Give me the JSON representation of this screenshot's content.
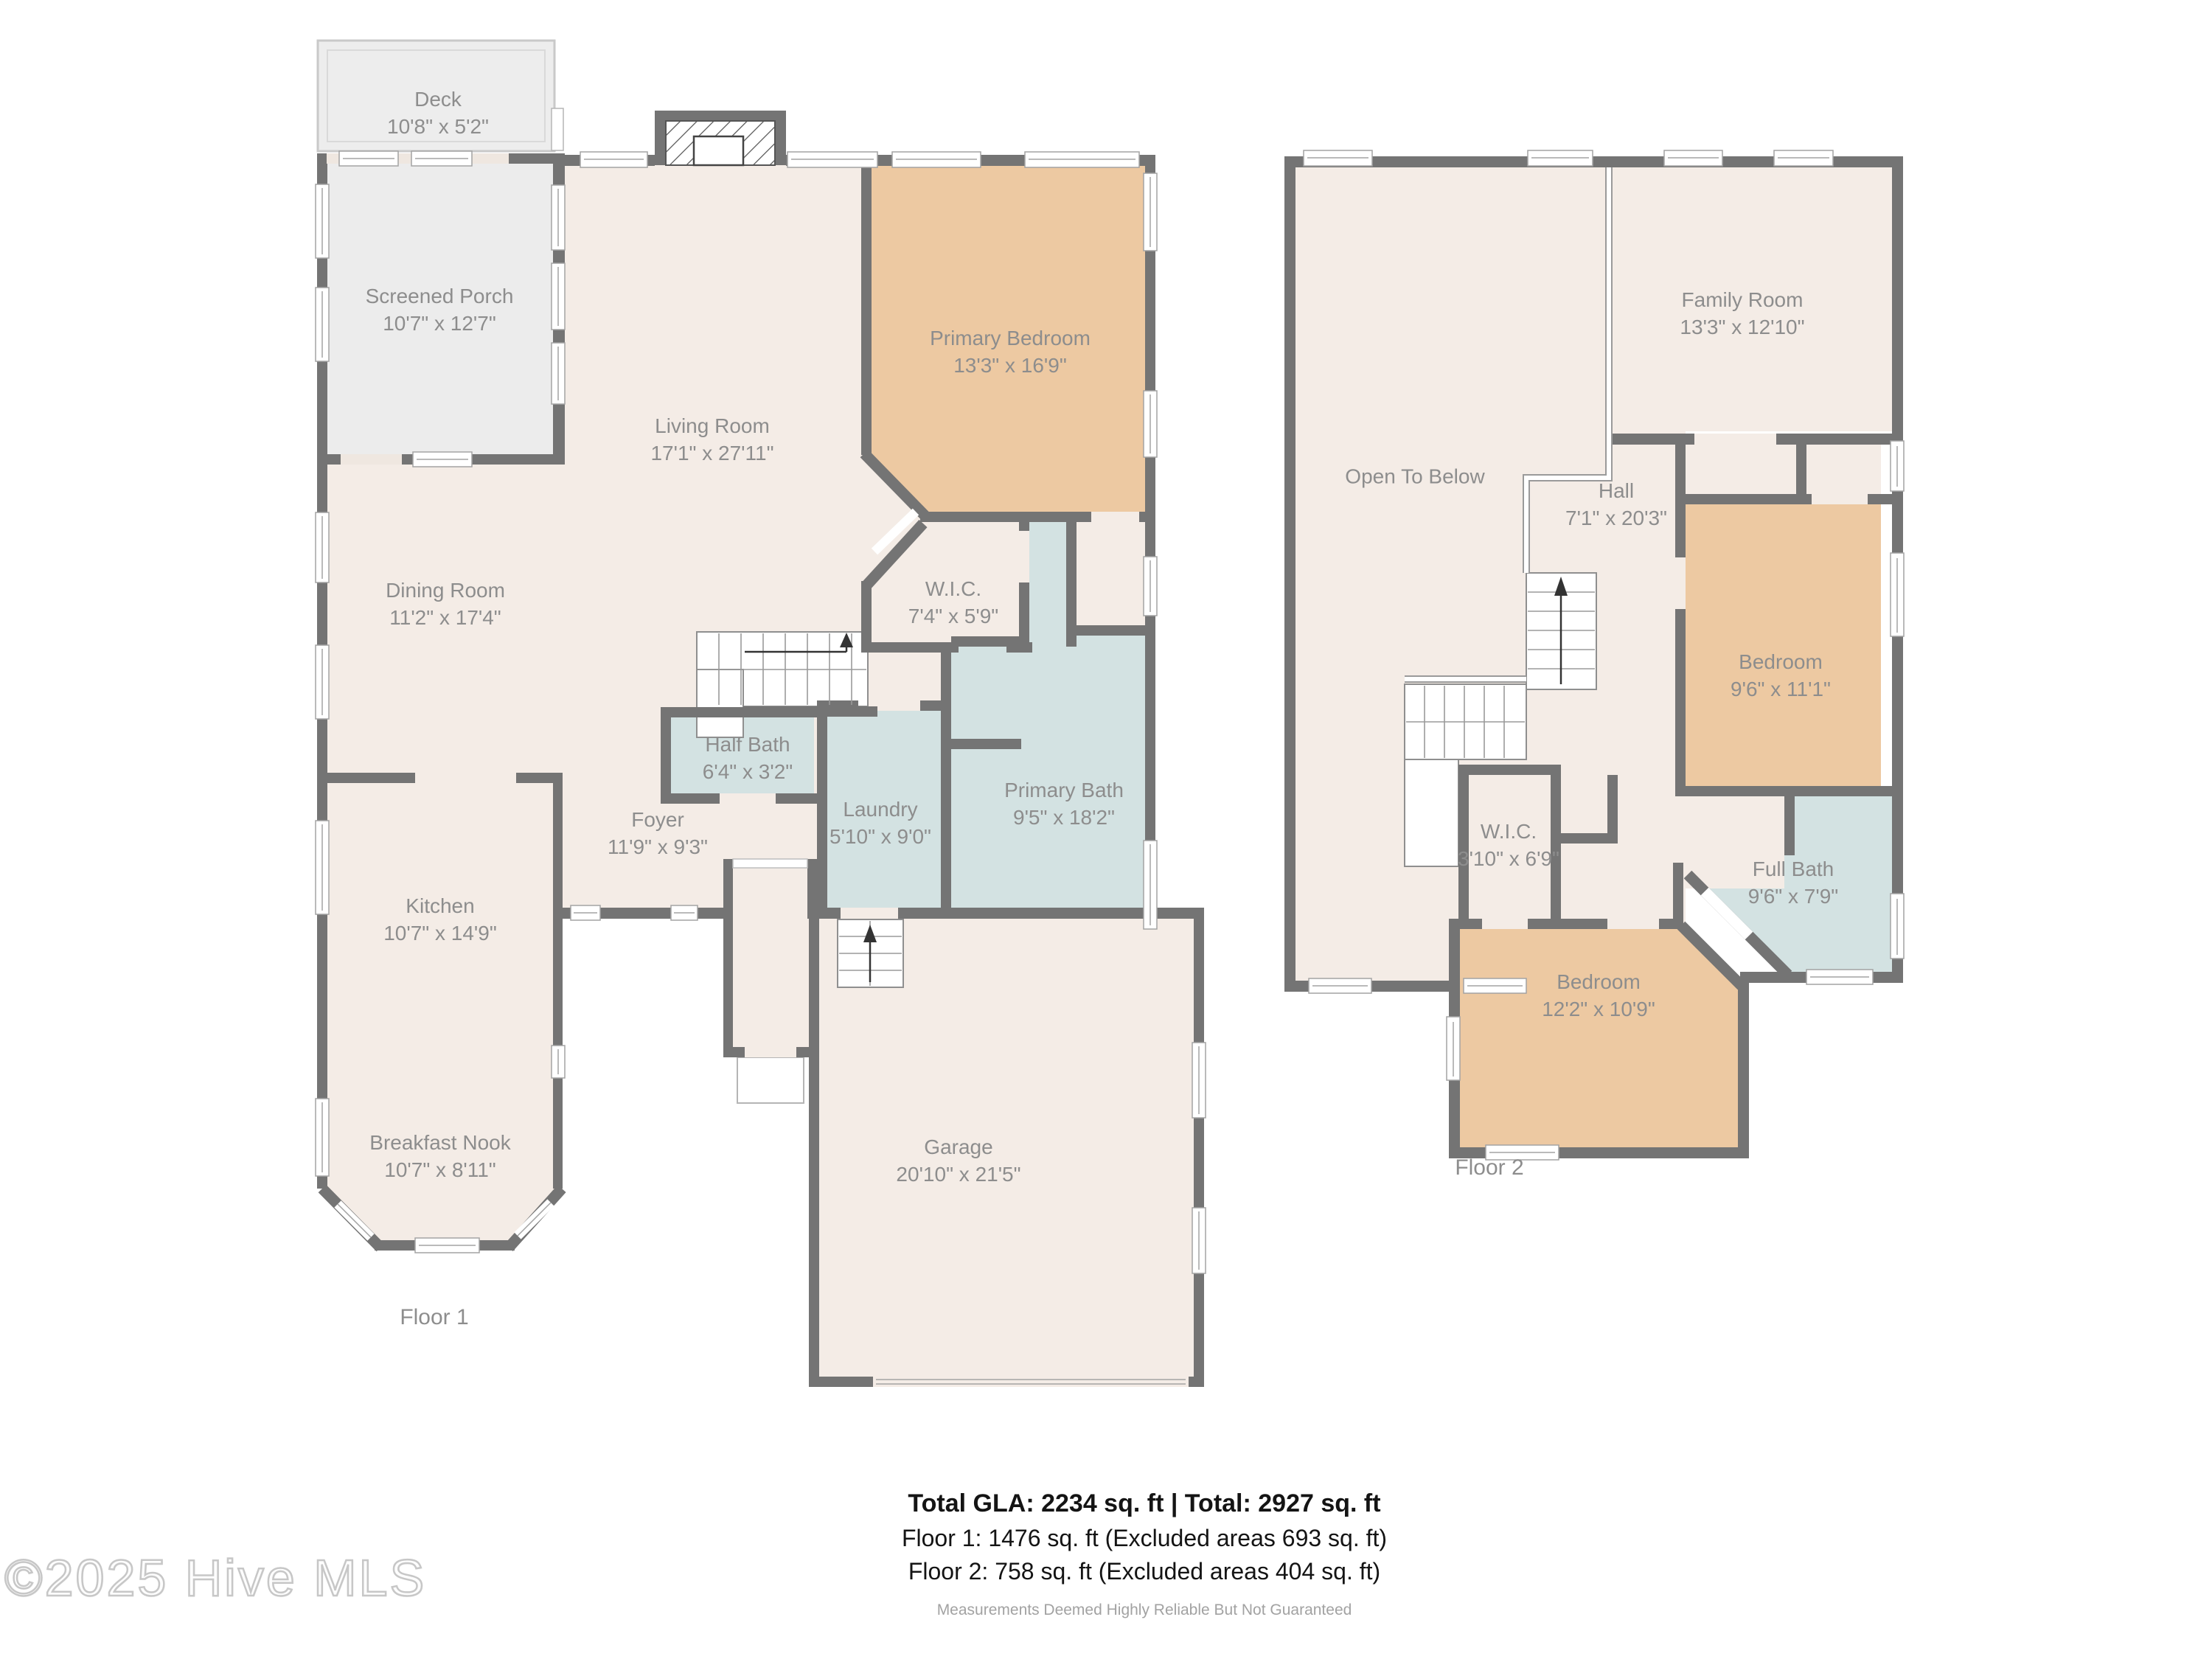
{
  "floor1": {
    "caption": "Floor 1",
    "rooms": [
      {
        "name": "Deck",
        "dims": "10'8\" x 5'2\""
      },
      {
        "name": "Screened Porch",
        "dims": "10'7\" x 12'7\""
      },
      {
        "name": "Living Room",
        "dims": "17'1\" x 27'11\""
      },
      {
        "name": "Primary Bedroom",
        "dims": "13'3\" x 16'9\""
      },
      {
        "name": "Dining Room",
        "dims": "11'2\" x 17'4\""
      },
      {
        "name": "W.I.C.",
        "dims": "7'4\" x 5'9\""
      },
      {
        "name": "Half Bath",
        "dims": "6'4\" x 3'2\""
      },
      {
        "name": "Laundry",
        "dims": "5'10\" x 9'0\""
      },
      {
        "name": "Primary Bath",
        "dims": "9'5\" x 18'2\""
      },
      {
        "name": "Foyer",
        "dims": "11'9\" x 9'3\""
      },
      {
        "name": "Kitchen",
        "dims": "10'7\" x 14'9\""
      },
      {
        "name": "Breakfast Nook",
        "dims": "10'7\" x 8'11\""
      },
      {
        "name": "Garage",
        "dims": "20'10\" x 21'5\""
      }
    ]
  },
  "floor2": {
    "caption": "Floor 2",
    "rooms": [
      {
        "name": "Family Room",
        "dims": "13'3\" x 12'10\""
      },
      {
        "name": "Open To Below",
        "dims": ""
      },
      {
        "name": "Hall",
        "dims": "7'1\" x 20'3\""
      },
      {
        "name": "Bedroom",
        "dims": "9'6\" x 11'1\""
      },
      {
        "name": "W.I.C.",
        "dims": "3'10\" x 6'9\""
      },
      {
        "name": "Full Bath",
        "dims": "9'6\" x 7'9\""
      },
      {
        "name": "Bedroom",
        "dims": "12'2\" x 10'9\""
      }
    ]
  },
  "summary": {
    "total": "Total GLA: 2234 sq. ft | Total: 2927 sq. ft",
    "floor1": "Floor 1: 1476 sq. ft (Excluded areas 693 sq. ft)",
    "floor2": "Floor 2: 758 sq. ft (Excluded areas 404 sq. ft)",
    "disclaimer": "Measurements Deemed Highly Reliable But Not Guaranteed"
  },
  "watermark": "©2025 Hive MLS",
  "colors": {
    "wall": "#747474",
    "room_fill": "#f4ece6",
    "bedroom_fill": "#edc9a2",
    "bath_fill": "#d3e2e2",
    "porch_fill": "#ececec",
    "label_text": "#8d8d8d"
  }
}
